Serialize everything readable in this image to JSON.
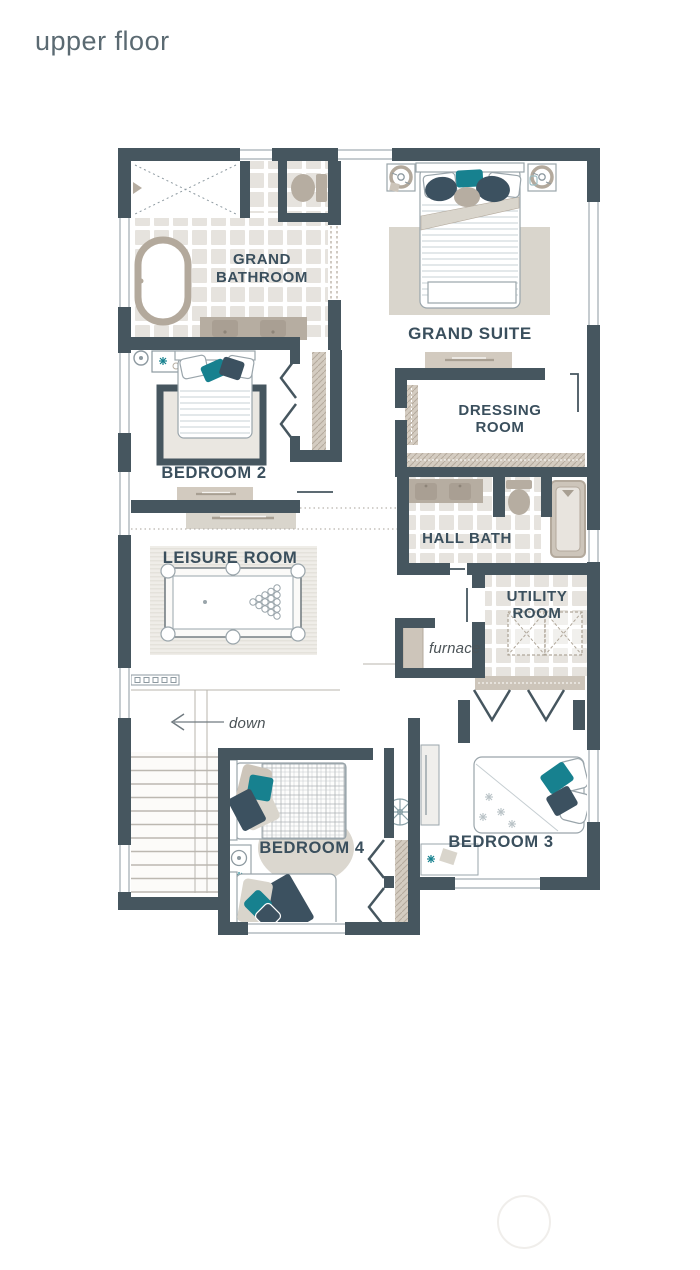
{
  "title": "upper floor",
  "plan": {
    "rooms": {
      "grand_bathroom": {
        "label": "GRAND BATHROOM",
        "lines": [
          "GRAND",
          "BATHROOM"
        ]
      },
      "grand_suite": {
        "label": "GRAND SUITE"
      },
      "bedroom_2": {
        "label": "BEDROOM 2"
      },
      "dressing_room": {
        "label": "DRESSING ROOM",
        "lines": [
          "DRESSING",
          "ROOM"
        ]
      },
      "hall_bath": {
        "label": "HALL BATH"
      },
      "leisure_room": {
        "label": "LEISURE ROOM"
      },
      "utility_room": {
        "label": "UTILITY ROOM",
        "lines": [
          "UTILITY",
          "ROOM"
        ]
      },
      "bedroom_4": {
        "label": "BEDROOM 4"
      },
      "bedroom_3": {
        "label": "BEDROOM 3"
      }
    },
    "annotations": {
      "furnace": {
        "label": "furnace"
      },
      "down": {
        "label": "down"
      }
    },
    "colors": {
      "wall": "#46565f",
      "room_label": "#3a4f5d",
      "accent_teal": "#17818f",
      "accent_navy": "#3c5160",
      "fixture_beige": "#b6ada1",
      "tile": "#e6e3de"
    }
  }
}
